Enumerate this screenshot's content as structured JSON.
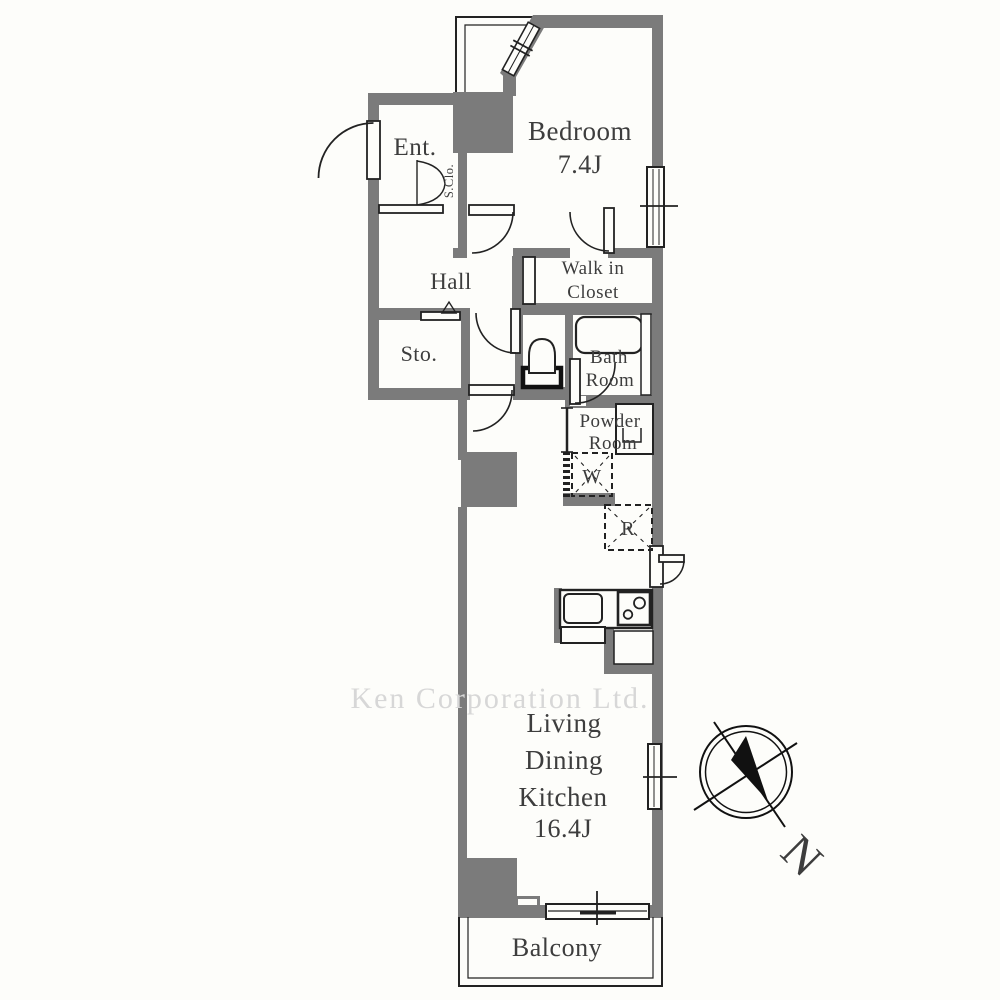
{
  "watermark": "Ken Corporation Ltd.",
  "compass": {
    "north_label": "N"
  },
  "rooms": {
    "bedroom": {
      "name": "Bedroom",
      "size": "7.4J"
    },
    "entrance": {
      "name": "Ent."
    },
    "shoe_closet": {
      "name": "S.Clo."
    },
    "hall": {
      "name": "Hall"
    },
    "storage": {
      "name": "Sto."
    },
    "walk_in_closet": {
      "line1": "Walk in",
      "line2": "Closet"
    },
    "bathroom": {
      "line1": "Bath",
      "line2": "Room"
    },
    "powder_room": {
      "line1": "Powder",
      "line2": "Room"
    },
    "washer": {
      "label": "W"
    },
    "refrigerator": {
      "label": "R"
    },
    "ldk": {
      "line1": "Living",
      "line2": "Dining",
      "line3": "Kitchen",
      "size": "16.4J"
    },
    "balcony": {
      "name": "Balcony"
    }
  },
  "colors": {
    "wall": "#7b7b7b",
    "line": "#222222",
    "text": "#3d3d3d",
    "watermark": "#d7d7d7",
    "background": "#fdfdfa"
  }
}
